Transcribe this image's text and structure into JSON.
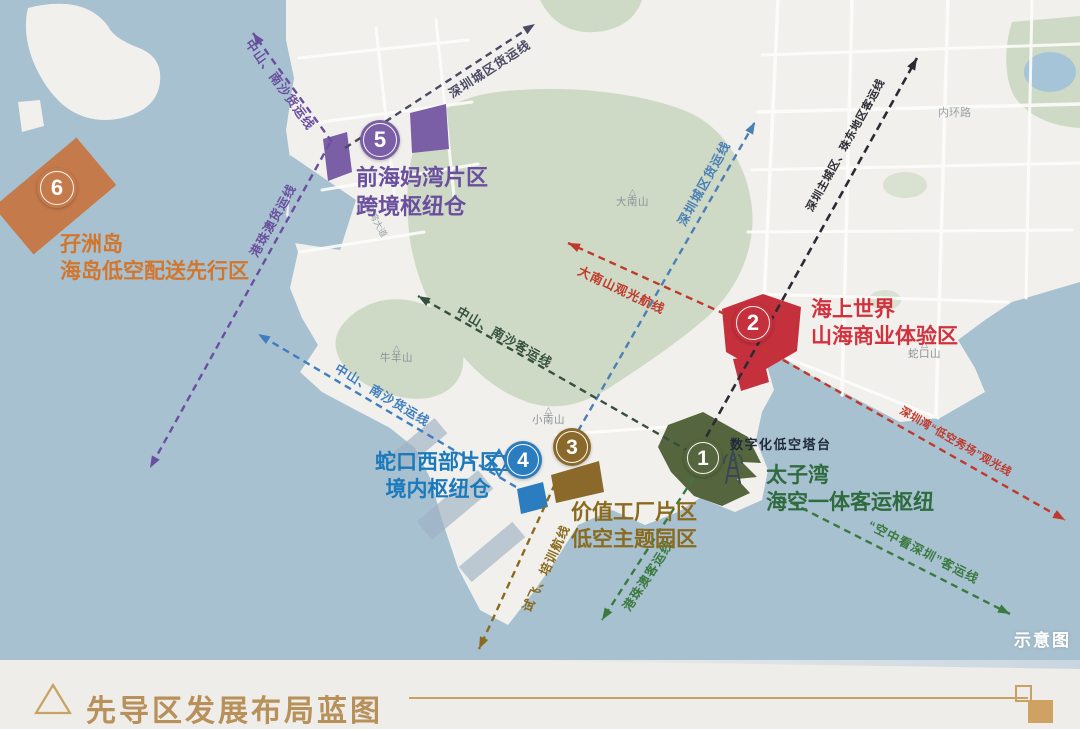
{
  "colors": {
    "water": "#a7c1d1",
    "land": "#f1f0ec",
    "park": "#cfdac6",
    "pond": "#a5c4d8",
    "road": "#fdfdfb",
    "basin": "#9fb3c5",
    "place_label": "#8a9197",
    "road_label": "#9aa2a8"
  },
  "zones": [
    {
      "number": "1",
      "name": "太子湾",
      "subtitle": "海空一体客运枢纽",
      "color": "#55663e",
      "text_color": "#2f6b3f"
    },
    {
      "number": "2",
      "name": "海上世界",
      "subtitle": "山海商业体验区",
      "color": "#c5303d",
      "text_color": "#d2323e"
    },
    {
      "number": "3",
      "name": "价值工厂片区",
      "subtitle": "低空主题园区",
      "color": "#8a692a",
      "text_color": "#8a6a1f"
    },
    {
      "number": "4",
      "name": "蛇口西部片区",
      "subtitle": "境内枢纽仓",
      "color": "#2b7dc0",
      "text_color": "#1a7abc"
    },
    {
      "number": "5",
      "name": "前海妈湾片区",
      "subtitle": "跨境枢纽仓",
      "color": "#7a5ea6",
      "text_color": "#6a4f9e"
    },
    {
      "number": "6",
      "name": "孖洲岛",
      "subtitle": "海岛低空配送先行区",
      "color": "#c57a4b",
      "text_color": "#d3762d"
    }
  ],
  "routes": [
    {
      "label": "中山、南沙货运线",
      "color": "#6a4f9e"
    },
    {
      "label": "深圳城区货运线",
      "color": "#4a4a66"
    },
    {
      "label": "港珠澳货运线",
      "color": "#6a4f9e"
    },
    {
      "label": "深圳主城区、珠东地区客运线",
      "color": "#2b2b33"
    },
    {
      "label": "深圳城区货运线",
      "color": "#4b7fb5"
    },
    {
      "label": "大南山观光航线",
      "color": "#c0392b"
    },
    {
      "label": "深圳湾“低空秀场”观光线",
      "color": "#c0392b"
    },
    {
      "label": "中山、南沙客运线",
      "color": "#35503f"
    },
    {
      "label": "中山、南沙货运线",
      "color": "#3f7fbf"
    },
    {
      "label": "试飞、培训航线",
      "color": "#8a6a1f"
    },
    {
      "label": "港珠澳客运线",
      "color": "#3a7a3f"
    },
    {
      "label": "“空中看深圳”客运线",
      "color": "#3a7a3f"
    }
  ],
  "facility": {
    "label": "数字化低空塔台",
    "color": "#1f2a3a",
    "icon_color": "#3a4656"
  },
  "places": [
    {
      "name": "大南山"
    },
    {
      "name": "小南山"
    },
    {
      "name": "牛羊山"
    },
    {
      "name": "蛇口山"
    }
  ],
  "roads": [
    {
      "name": "内环路"
    },
    {
      "name": "月亮湾大道"
    }
  ],
  "watermark": {
    "text": "示意图",
    "color": "#ffffff"
  },
  "footer": {
    "title": "先导区发展布局蓝图",
    "accent": "#c8a262",
    "title_color": "#b8905a",
    "square_fill": "#cfa263",
    "bg": "#eeedea"
  }
}
